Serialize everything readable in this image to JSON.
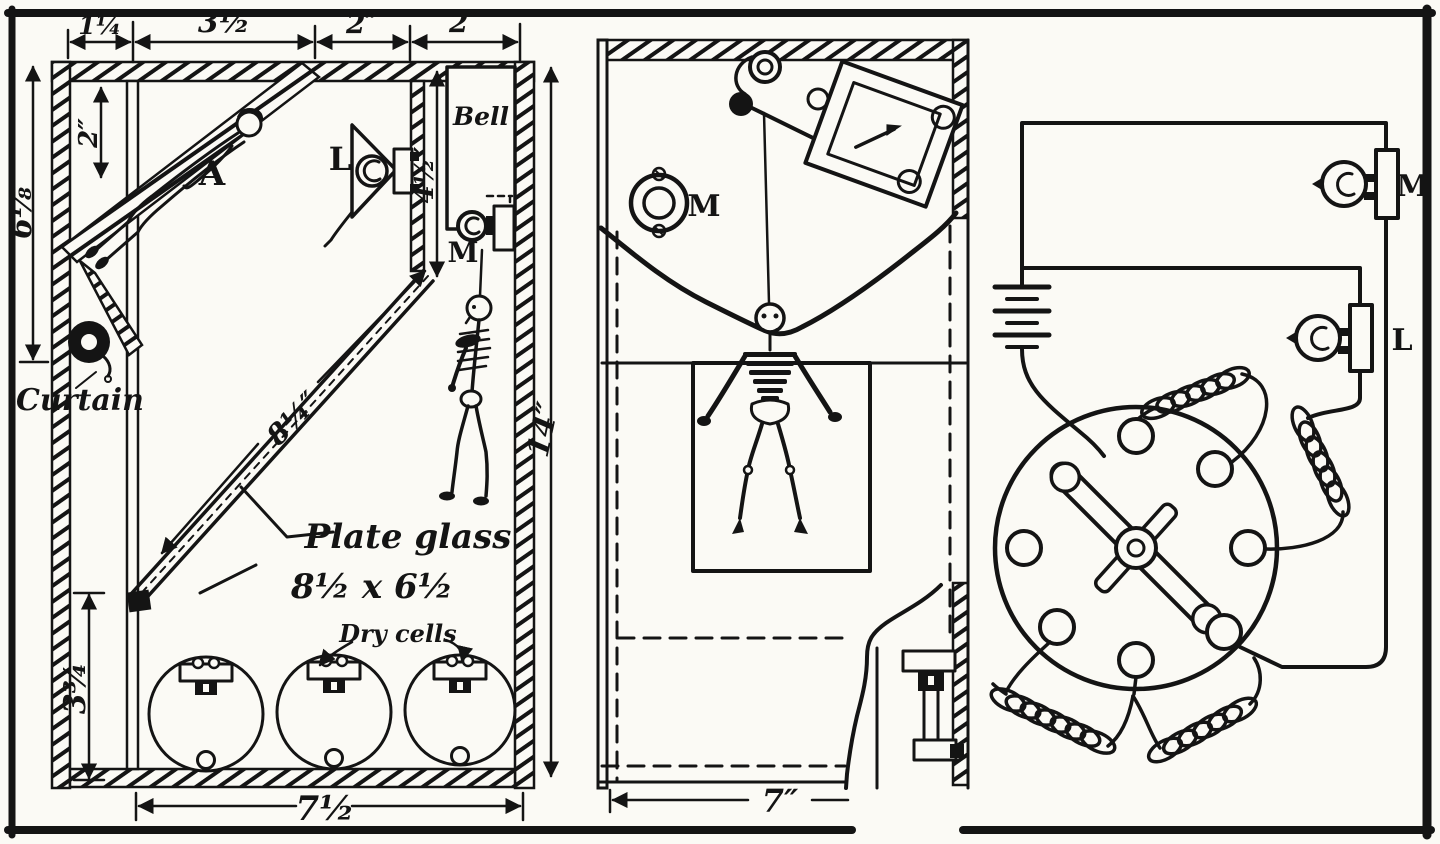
{
  "colors": {
    "ink": "#141414",
    "paper": "#fbfaf5"
  },
  "side_view": {
    "dims": {
      "top_a": "1¼",
      "top_b": "3½",
      "top_c": "2″",
      "top_d": "2″",
      "left_outer": "6⅛",
      "left_inner": "2″",
      "bell_height": "4½″",
      "right_height": "14″",
      "glass_diagonal": "8¼″",
      "cell_height": "3¾",
      "bottom_width": "7½"
    },
    "labels": {
      "assistant": "A",
      "lamp": "L",
      "bell": "Bell",
      "magnet": "M",
      "curtain": "Curtain",
      "glass_line1": "Plate glass",
      "glass_line2": "8½ x 6½",
      "cells": "Dry cells"
    }
  },
  "front_view": {
    "labels": {
      "magnet": "M"
    },
    "dims": {
      "bottom_width": "7″"
    }
  },
  "circuit": {
    "labels": {
      "lamp_m": "M",
      "lamp_l": "L"
    }
  }
}
